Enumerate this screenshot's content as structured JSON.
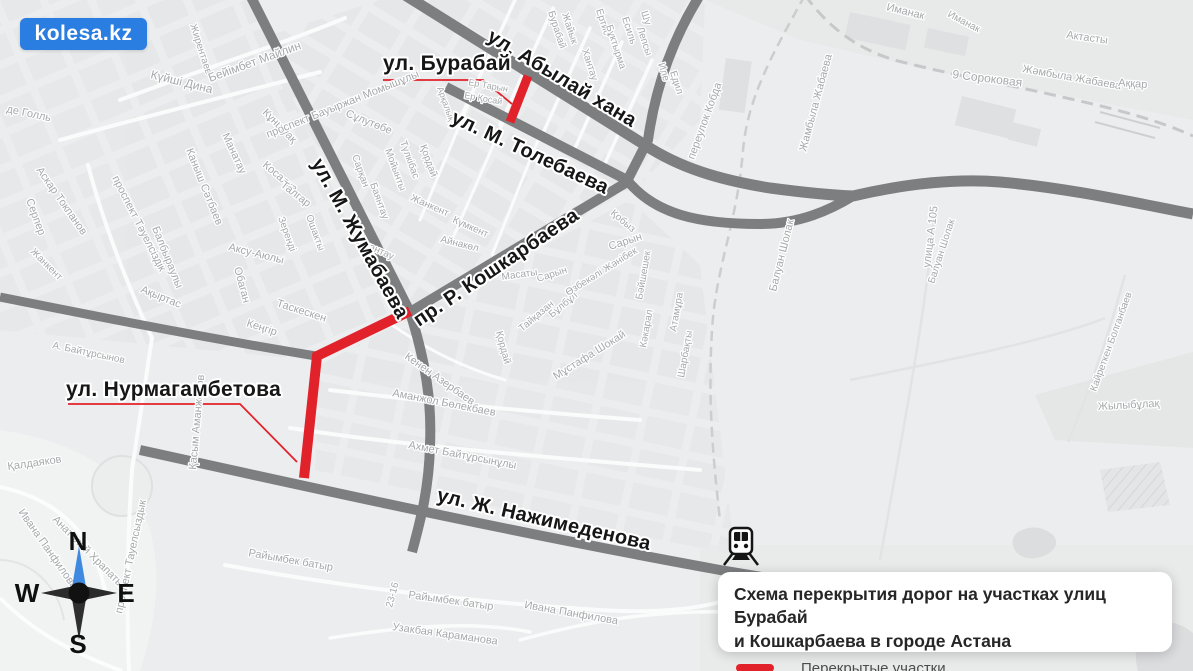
{
  "logo": {
    "text": "kolesa.kz",
    "bg_color": "#2a7de1"
  },
  "legend": {
    "title_line1": "Схема перекрытия дорог на участках улиц Бурабай",
    "title_line2": "и Кошкарбаева в городе Астана",
    "closed_label": "Перекрытые участки",
    "closed_color": "#e2222a"
  },
  "compass": {
    "n": "N",
    "e": "E",
    "s": "S",
    "w": "W",
    "north_color": "#3f8ae0"
  },
  "colors": {
    "map_bg": "#ecedee",
    "road": "#7d7e80",
    "closure": "#e2222a",
    "major_label": "#161616",
    "minor_label": "#a6a8aa",
    "railway": "#c6c8c9"
  },
  "map": {
    "major_labels": [
      {
        "name": "abylai-khana",
        "text": "ул. Абылай хана",
        "x": 486,
        "y": 40,
        "rot": 31,
        "size": 20
      },
      {
        "name": "burabai",
        "text": "ул. Бурабай",
        "x": 383,
        "y": 70,
        "rot": 0,
        "size": 21
      },
      {
        "name": "tolebaeva",
        "text": "ул. М. Толебаева",
        "x": 450,
        "y": 122,
        "rot": 25,
        "size": 20
      },
      {
        "name": "zhumabaeva",
        "text": "ул. М. Жумабаева",
        "x": 311,
        "y": 163,
        "rot": 61,
        "size": 20
      },
      {
        "name": "koshkarbaeva",
        "text": "пр. Р. Кошкарбаева",
        "x": 419,
        "y": 327,
        "rot": -34,
        "size": 20
      },
      {
        "name": "nurmagambetova",
        "text": "ул. Нурмагамбетова",
        "x": 66,
        "y": 396,
        "rot": 0,
        "size": 21
      },
      {
        "name": "nazhimedenova",
        "text": "ул. Ж. Нажимеденова",
        "x": 436,
        "y": 501,
        "rot": 13,
        "size": 20
      }
    ],
    "minor_labels": [
      {
        "text": "Жирентаев",
        "x": 190,
        "y": 25,
        "rot": 72,
        "size": 10
      },
      {
        "text": "Күйші Дина",
        "x": 150,
        "y": 78,
        "rot": 14,
        "size": 12
      },
      {
        "text": "Бейімбет Майлин",
        "x": 210,
        "y": 82,
        "rot": -20,
        "size": 12
      },
      {
        "text": "Кұншуақ",
        "x": 262,
        "y": 113,
        "rot": 45,
        "size": 11
      },
      {
        "text": "Каныш Сәтбаев",
        "x": 186,
        "y": 150,
        "rot": 68,
        "size": 11
      },
      {
        "text": "Манатау",
        "x": 222,
        "y": 135,
        "rot": 65,
        "size": 11
      },
      {
        "text": "де Голль",
        "x": 6,
        "y": 112,
        "rot": 12,
        "size": 11
      },
      {
        "text": "Аскар Токпанов",
        "x": 36,
        "y": 170,
        "rot": 55,
        "size": 11
      },
      {
        "text": "Серпер",
        "x": 26,
        "y": 200,
        "rot": 70,
        "size": 11
      },
      {
        "text": "проспект Тәуелсіздік",
        "x": 112,
        "y": 178,
        "rot": 63,
        "size": 11
      },
      {
        "text": "Балбыраулы",
        "x": 152,
        "y": 228,
        "rot": 68,
        "size": 11
      },
      {
        "text": "Ақыртас",
        "x": 140,
        "y": 292,
        "rot": 22,
        "size": 11
      },
      {
        "text": "проспект Бауыржан Момышұлы",
        "x": 268,
        "y": 138,
        "rot": -22,
        "size": 11
      },
      {
        "text": "Сұлутөбе",
        "x": 345,
        "y": 116,
        "rot": 22,
        "size": 11
      },
      {
        "text": "Косалқа",
        "x": 262,
        "y": 166,
        "rot": 40,
        "size": 11
      },
      {
        "text": "Талгар",
        "x": 280,
        "y": 186,
        "rot": 38,
        "size": 11
      },
      {
        "text": "Зеренді",
        "x": 278,
        "y": 218,
        "rot": 70,
        "size": 10
      },
      {
        "text": "Ошакты",
        "x": 306,
        "y": 216,
        "rot": 70,
        "size": 10
      },
      {
        "text": "Аксу-Аюлы",
        "x": 228,
        "y": 250,
        "rot": 14,
        "size": 11
      },
      {
        "text": "Обаган",
        "x": 234,
        "y": 268,
        "rot": 75,
        "size": 11
      },
      {
        "text": "Таскескен",
        "x": 276,
        "y": 306,
        "rot": 18,
        "size": 11
      },
      {
        "text": "Кеңгір",
        "x": 246,
        "y": 326,
        "rot": 18,
        "size": 11
      },
      {
        "text": "Жанкент",
        "x": 30,
        "y": 252,
        "rot": 45,
        "size": 10
      },
      {
        "text": "Сарқан",
        "x": 352,
        "y": 156,
        "rot": 70,
        "size": 10
      },
      {
        "text": "Мойынты",
        "x": 385,
        "y": 150,
        "rot": 70,
        "size": 10
      },
      {
        "text": "Түлкібас",
        "x": 400,
        "y": 142,
        "rot": 70,
        "size": 10
      },
      {
        "text": "Баянтау",
        "x": 370,
        "y": 184,
        "rot": 70,
        "size": 10
      },
      {
        "text": "Қордай",
        "x": 420,
        "y": 146,
        "rot": 70,
        "size": 10
      },
      {
        "text": "Балқантау",
        "x": 348,
        "y": 240,
        "rot": 24,
        "size": 10
      },
      {
        "text": "Жанкент",
        "x": 410,
        "y": 200,
        "rot": 24,
        "size": 10
      },
      {
        "text": "Күмкент",
        "x": 452,
        "y": 222,
        "rot": 24,
        "size": 10
      },
      {
        "text": "Айнакөл",
        "x": 440,
        "y": 242,
        "rot": 14,
        "size": 10
      },
      {
        "text": "Ер Тарын",
        "x": 468,
        "y": 85,
        "rot": 10,
        "size": 9
      },
      {
        "text": "Ер Қосай",
        "x": 464,
        "y": 98,
        "rot": 10,
        "size": 9
      },
      {
        "text": "Арқалық",
        "x": 437,
        "y": 88,
        "rot": 70,
        "size": 9
      },
      {
        "text": "Бурабай",
        "x": 548,
        "y": 12,
        "rot": 72,
        "size": 10
      },
      {
        "text": "Жайык",
        "x": 562,
        "y": 14,
        "rot": 72,
        "size": 10
      },
      {
        "text": "Хантау",
        "x": 582,
        "y": 50,
        "rot": 72,
        "size": 10
      },
      {
        "text": "Ертис",
        "x": 596,
        "y": 10,
        "rot": 72,
        "size": 10
      },
      {
        "text": "Бұктырма",
        "x": 606,
        "y": 26,
        "rot": 72,
        "size": 10
      },
      {
        "text": "Есиль",
        "x": 622,
        "y": 18,
        "rot": 72,
        "size": 10
      },
      {
        "text": "Шу",
        "x": 641,
        "y": 12,
        "rot": 72,
        "size": 10
      },
      {
        "text": "Лепсы",
        "x": 637,
        "y": 28,
        "rot": 72,
        "size": 10
      },
      {
        "text": "Иле",
        "x": 658,
        "y": 64,
        "rot": 72,
        "size": 10
      },
      {
        "text": "Едил",
        "x": 670,
        "y": 72,
        "rot": 72,
        "size": 10
      },
      {
        "text": "Қобыз",
        "x": 610,
        "y": 214,
        "rot": 40,
        "size": 10
      },
      {
        "text": "переулок Кобда",
        "x": 694,
        "y": 160,
        "rot": -70,
        "size": 11
      },
      {
        "text": "Жамбыла Жабаева",
        "x": 806,
        "y": 152,
        "rot": -75,
        "size": 11
      },
      {
        "text": "9 Сороковая",
        "x": 952,
        "y": 78,
        "rot": 7,
        "size": 12
      },
      {
        "text": "Жәмбыла Жабаева",
        "x": 1022,
        "y": 72,
        "rot": 10,
        "size": 11
      },
      {
        "text": "Актасты",
        "x": 1066,
        "y": 38,
        "rot": 8,
        "size": 11
      },
      {
        "text": "Аққар",
        "x": 1118,
        "y": 86,
        "rot": 4,
        "size": 11
      },
      {
        "text": "Иманак",
        "x": 886,
        "y": 10,
        "rot": 14,
        "size": 11
      },
      {
        "text": "Иманак",
        "x": 947,
        "y": 16,
        "rot": 28,
        "size": 10
      },
      {
        "text": "Балуан Шолак",
        "x": 776,
        "y": 292,
        "rot": -76,
        "size": 11
      },
      {
        "text": "Балуан Шолак",
        "x": 934,
        "y": 284,
        "rot": -72,
        "size": 10
      },
      {
        "text": "улица А 105",
        "x": 930,
        "y": 268,
        "rot": -83,
        "size": 11
      },
      {
        "text": "Сарын",
        "x": 610,
        "y": 250,
        "rot": -18,
        "size": 11
      },
      {
        "text": "Сарын",
        "x": 538,
        "y": 282,
        "rot": -18,
        "size": 10
      },
      {
        "text": "Масаты",
        "x": 502,
        "y": 280,
        "rot": -8,
        "size": 10
      },
      {
        "text": "Тайқазан",
        "x": 522,
        "y": 332,
        "rot": -40,
        "size": 10
      },
      {
        "text": "Бұлбұл",
        "x": 552,
        "y": 318,
        "rot": -40,
        "size": 10
      },
      {
        "text": "Қордай",
        "x": 496,
        "y": 332,
        "rot": 75,
        "size": 10
      },
      {
        "text": "Мұстафа Шокай",
        "x": 556,
        "y": 380,
        "rot": -32,
        "size": 11
      },
      {
        "text": "Өзбекәлі Жәнібек",
        "x": 568,
        "y": 296,
        "rot": -32,
        "size": 10
      },
      {
        "text": "Бәйшешек",
        "x": 642,
        "y": 300,
        "rot": -80,
        "size": 10
      },
      {
        "text": "Кәкарал",
        "x": 646,
        "y": 348,
        "rot": -80,
        "size": 10
      },
      {
        "text": "Атамұра",
        "x": 676,
        "y": 332,
        "rot": -80,
        "size": 10
      },
      {
        "text": "Шарбақты",
        "x": 684,
        "y": 378,
        "rot": -80,
        "size": 10
      },
      {
        "text": "Кенен Азербаев",
        "x": 404,
        "y": 358,
        "rot": 35,
        "size": 11
      },
      {
        "text": "Аманжол Бөлекбаев",
        "x": 392,
        "y": 396,
        "rot": 11,
        "size": 11
      },
      {
        "text": "Ахмет Байтұрсынұлы",
        "x": 408,
        "y": 448,
        "rot": 11,
        "size": 11
      },
      {
        "text": "Қасым Аманжолов",
        "x": 196,
        "y": 470,
        "rot": -85,
        "size": 11
      },
      {
        "text": "Қалдаяков",
        "x": 8,
        "y": 470,
        "rot": -8,
        "size": 11
      },
      {
        "text": "Ивана Панфилова",
        "x": 18,
        "y": 512,
        "rot": 55,
        "size": 11
      },
      {
        "text": "Анатолий Храпатый",
        "x": 52,
        "y": 520,
        "rot": 45,
        "size": 11
      },
      {
        "text": "проспект Тауелсыздык",
        "x": 122,
        "y": 614,
        "rot": -78,
        "size": 11
      },
      {
        "text": "Райымбек батыр",
        "x": 248,
        "y": 556,
        "rot": 10,
        "size": 11
      },
      {
        "text": "Райымбек батыр",
        "x": 408,
        "y": 598,
        "rot": 8,
        "size": 11
      },
      {
        "text": "Узакбая Караманова",
        "x": 392,
        "y": 630,
        "rot": 8,
        "size": 11
      },
      {
        "text": "Ивана Панфилова",
        "x": 524,
        "y": 608,
        "rot": 10,
        "size": 11
      },
      {
        "text": "23-16",
        "x": 392,
        "y": 608,
        "rot": -75,
        "size": 10
      },
      {
        "text": "А. Байтұрсынов",
        "x": 52,
        "y": 348,
        "rot": 12,
        "size": 10
      },
      {
        "text": "Жылыбұлақ",
        "x": 1098,
        "y": 410,
        "rot": -3,
        "size": 11
      },
      {
        "text": "Кайреткен Болганбаев",
        "x": 1096,
        "y": 392,
        "rot": -70,
        "size": 10
      }
    ]
  }
}
